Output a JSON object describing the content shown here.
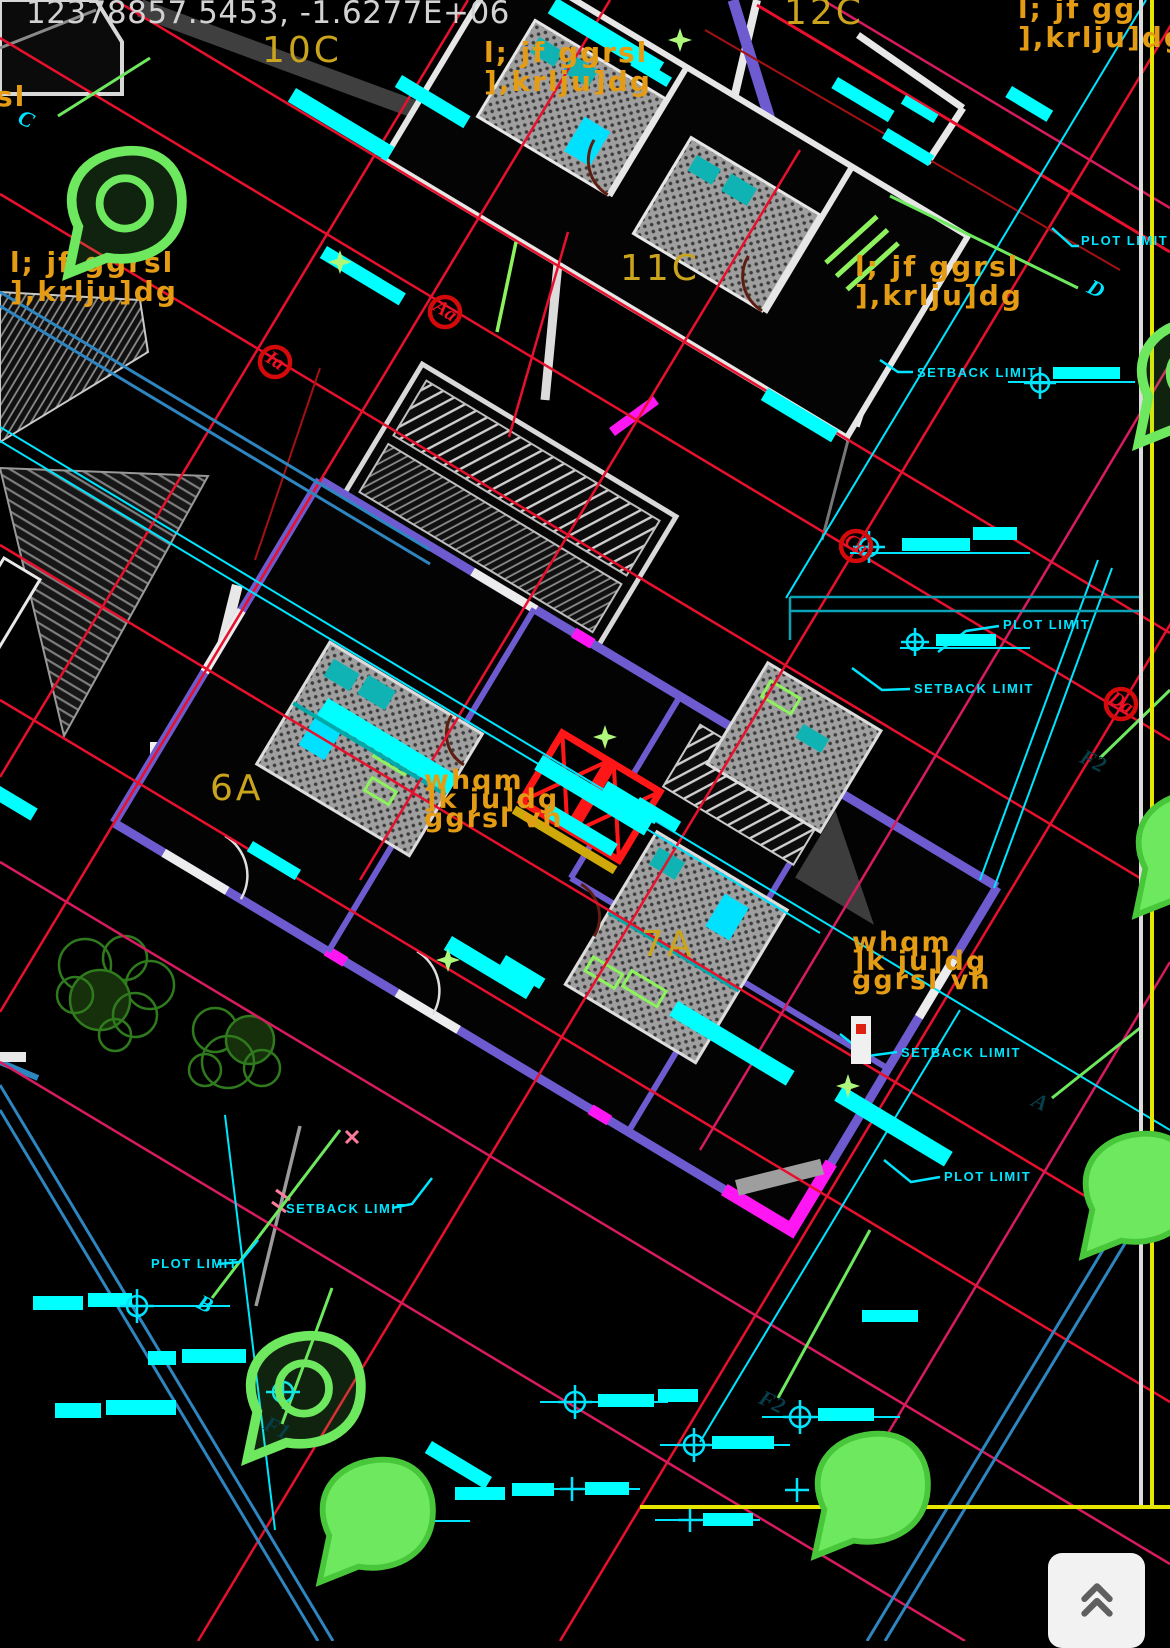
{
  "app": {
    "coordinate_readout": "12378857.5453,  -1.6277E+06"
  },
  "colors": {
    "background": "#000000",
    "grid_red": "#e8112d",
    "setback_crimson": "#d81b60",
    "limit_cyan": "#00e5ff",
    "wall_violet": "#6f5bd0",
    "wall_magenta": "#ff17f3",
    "flag_green": "#6ee85e",
    "annotation_orange": "#e39c13",
    "unit_yellow": "#caa41c",
    "boundary_yellow": "#e6e600",
    "elevator_red": "#ff1616"
  },
  "labels": {
    "units": [
      {
        "text": "10C",
        "x": 262,
        "y": 30,
        "size": 36
      },
      {
        "text": "12C",
        "x": 784,
        "y": -8,
        "size": 36
      },
      {
        "text": "11C",
        "x": 620,
        "y": 248,
        "size": 36
      },
      {
        "text": "6A",
        "x": 210,
        "y": 768,
        "size": 36
      },
      {
        "text": "7A",
        "x": 641,
        "y": 924,
        "size": 36
      }
    ],
    "annotations": [
      {
        "lines": [
          "l; jf  ggrsl",
          "],krlju]dg"
        ],
        "x": 484,
        "y": 38,
        "size": 28,
        "tight": false
      },
      {
        "lines": [
          "l; jf  gg",
          "],krlju]dg"
        ],
        "x": 1018,
        "y": -6,
        "size": 28,
        "tight": false
      },
      {
        "lines": [
          "l; jf  ggrsl",
          "],krlju]dg"
        ],
        "x": 855,
        "y": 252,
        "size": 28,
        "tight": false
      },
      {
        "lines": [
          "sl"
        ],
        "x": -4,
        "y": 82,
        "size": 28,
        "tight": false
      },
      {
        "lines": [
          "l; jf  ggrsl",
          "],krlju]dg"
        ],
        "x": 10,
        "y": 248,
        "size": 28,
        "tight": false
      },
      {
        "lines": [
          "whqm",
          "]k  ju]dg",
          "ggrsl  vh"
        ],
        "x": 424,
        "y": 772,
        "size": 27,
        "tight": true
      },
      {
        "lines": [
          "whqm",
          "]k  ju]dg",
          "ggrsl  vh"
        ],
        "x": 852,
        "y": 934,
        "size": 27,
        "tight": true
      }
    ],
    "limits": [
      {
        "text": "PLOT LIMIT",
        "x": 1081,
        "y": 233
      },
      {
        "text": "SETBACK LIMIT",
        "x": 917,
        "y": 365
      },
      {
        "text": "PLOT LIMIT",
        "x": 1003,
        "y": 617
      },
      {
        "text": "SETBACK LIMIT",
        "x": 914,
        "y": 681
      },
      {
        "text": "SETBACK LIMIT",
        "x": 901,
        "y": 1045
      },
      {
        "text": "PLOT LIMIT",
        "x": 944,
        "y": 1169
      },
      {
        "text": "SETBACK LIMIT",
        "x": 286,
        "y": 1201
      },
      {
        "text": "PLOT LIMIT",
        "x": 151,
        "y": 1256
      }
    ],
    "grid_bubbles": [
      {
        "text": "Aa",
        "x": 445,
        "y": 312
      },
      {
        "text": "Ia",
        "x": 275,
        "y": 362
      },
      {
        "text": "Ca",
        "x": 856,
        "y": 546
      },
      {
        "text": "Da",
        "x": 1121,
        "y": 704
      }
    ],
    "station_flags": [
      {
        "text": "C",
        "x": 26,
        "y": 121,
        "style": "outline"
      },
      {
        "text": "D",
        "x": 1096,
        "y": 291,
        "style": "outline"
      },
      {
        "text": "F2",
        "x": 1093,
        "y": 763,
        "style": "filled"
      },
      {
        "text": "A",
        "x": 1040,
        "y": 1104,
        "style": "filled"
      },
      {
        "text": "B",
        "x": 205,
        "y": 1306,
        "style": "outline"
      },
      {
        "text": "F2",
        "x": 772,
        "y": 1404,
        "style": "filled"
      },
      {
        "text": "F1",
        "x": 277,
        "y": 1430,
        "style": "filled"
      }
    ]
  },
  "controls": {
    "scroll_to_top_icon": "chevron-double-up"
  }
}
